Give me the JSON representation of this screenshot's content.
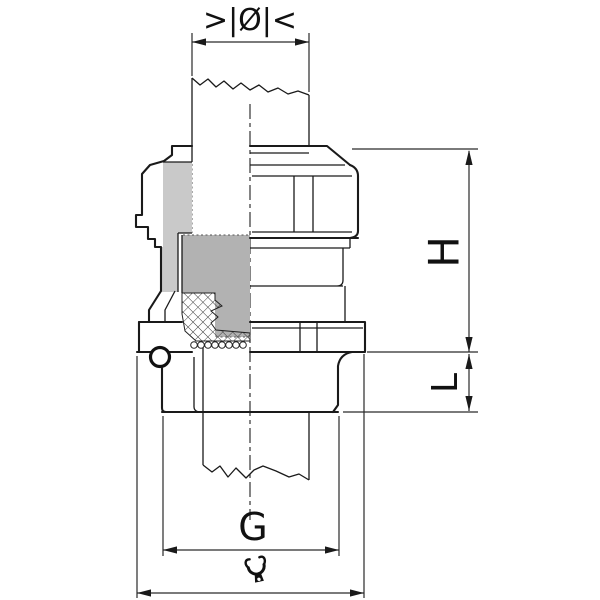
{
  "drawing": {
    "type": "technical-diagram",
    "subject": "cable gland half-section with dimension references"
  },
  "labels": {
    "diameter": ">|Ø|<",
    "height": "H",
    "length": "L",
    "thread": "G"
  },
  "icons": {
    "bottom_dimension": "wrench-icon"
  },
  "colors": {
    "line": "#1a1a1a",
    "section_light": "#c9c9c9",
    "section_mid": "#b2b2b2",
    "background": "#ffffff"
  }
}
